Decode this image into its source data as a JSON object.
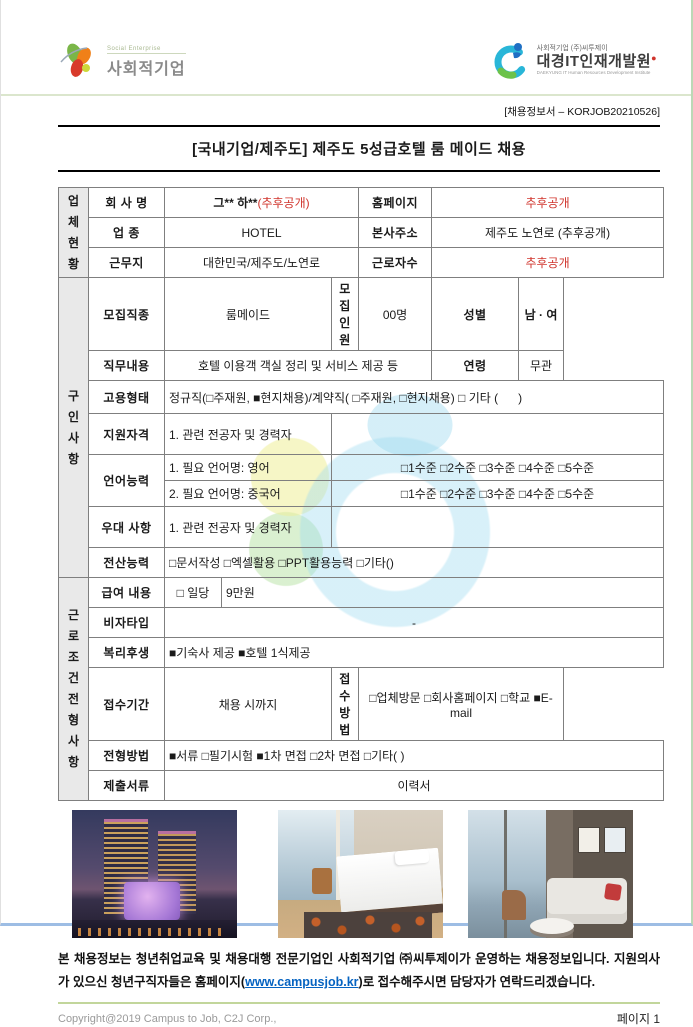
{
  "header": {
    "left_logo": {
      "subtitle": "Social Enterprise",
      "title": "사회적기업"
    },
    "right_logo": {
      "top": "사회적기업 (주)씨투제이",
      "title": "대경IT인재개발원",
      "subtitle": "DAEKYUNG IT Human Resources Development Institute"
    },
    "doc_code": "[채용정보서 – KORJOB20210526]"
  },
  "title": "[국내기업/제주도] 제주도 5성급호텔 룸 메이드 채용",
  "table": {
    "sections": {
      "company": "업\n체\n현\n황",
      "recruit": "구\n인\n사\n항",
      "conditions": "근\n로\n조\n건\n전\n형\n사\n항"
    },
    "company": {
      "name_label": "회 사 명",
      "name_value": "그** 하**",
      "name_note": "(추후공개)",
      "homepage_label": "홈페이지",
      "homepage_value": "추후공개",
      "industry_label": "업 종",
      "industry_value": "HOTEL",
      "hq_label": "본사주소",
      "hq_value": "제주도 노연로 (추후공개)",
      "worksite_label": "근무지",
      "worksite_value": "대한민국/제주도/노연로",
      "workers_label": "근로자수",
      "workers_value": "추후공개"
    },
    "recruit": {
      "job_label": "모집직종",
      "job_value": "룸메이드",
      "headcount_label": "모집인원",
      "headcount_value": "00명",
      "gender_label": "성별",
      "gender_value": "남 · 여",
      "duties_label": "직무내용",
      "duties_value": "호텔 이용객 객실 정리 및 서비스 제공 등",
      "age_label": "연령",
      "age_value": "무관",
      "employment_label": "고용형태",
      "employment_value": "정규직(□주재원, ■현지채용)/계약직( □주재원, □현지채용) □ 기타 (      )",
      "qualification_label": "지원자격",
      "qualification_value": "1. 관련 전공자 및 경력자",
      "language_label": "언어능력",
      "language1_name": "1. 필요 언어명: 영어",
      "language1_levels": "□1수준 □2수준 □3수준 □4수준 □5수준",
      "language2_name": "2. 필요 언어명: 중국어",
      "language2_levels": "□1수준 □2수준 □3수준 □4수준 □5수준",
      "preference_label": "우대 사항",
      "preference_value": "1. 관련 전공자 및 경력자",
      "computer_label": "전산능력",
      "computer_value": "□문서작성 □엑셀활용 □PPT활용능력 □기타()"
    },
    "conditions": {
      "salary_label": "급여 내용",
      "salary_type": "□ 일당",
      "salary_amount": "9만원",
      "visa_label": "비자타입",
      "visa_value": "-",
      "welfare_label": "복리후생",
      "welfare_value": "■기숙사 제공 ■호텔 1식제공",
      "period_label": "접수기간",
      "period_value": "채용 시까지",
      "method_label": "접수방법",
      "method_value": "□업체방문 □회사홈페이지 □학교 ■E-mail",
      "process_label": "전형방법",
      "process_value": "■서류 □필기시험 ■1차 면접 □2차 면접 □기타( )",
      "documents_label": "제출서류",
      "documents_value": "이력서"
    }
  },
  "photos": {
    "photo1": "hotel-exterior-night",
    "photo2": "hotel-bedroom",
    "photo3": "hotel-lounge"
  },
  "notice": {
    "before_link": "본 채용정보는 청년취업교육 및 채용대행 전문기업인 사회적기업 ㈜씨투제이가 운영하는 채용정보입니다. 지원의사가 있으신 청년구직자들은 홈페이지(",
    "link": "www.campusjob.kr",
    "after_link": ")로 접수해주시면 담당자가 연락드리겠습니다."
  },
  "footer": {
    "copyright": "Copyright@2019 Campus to Job, C2J Corp.,",
    "page": "페이지 1"
  },
  "colors": {
    "accent_red": "#d0342c",
    "link_blue": "#0563c1",
    "section_gray": "#e9e9e9",
    "border_gray": "#7f7f7f",
    "divider_green": "#c2d69b"
  }
}
